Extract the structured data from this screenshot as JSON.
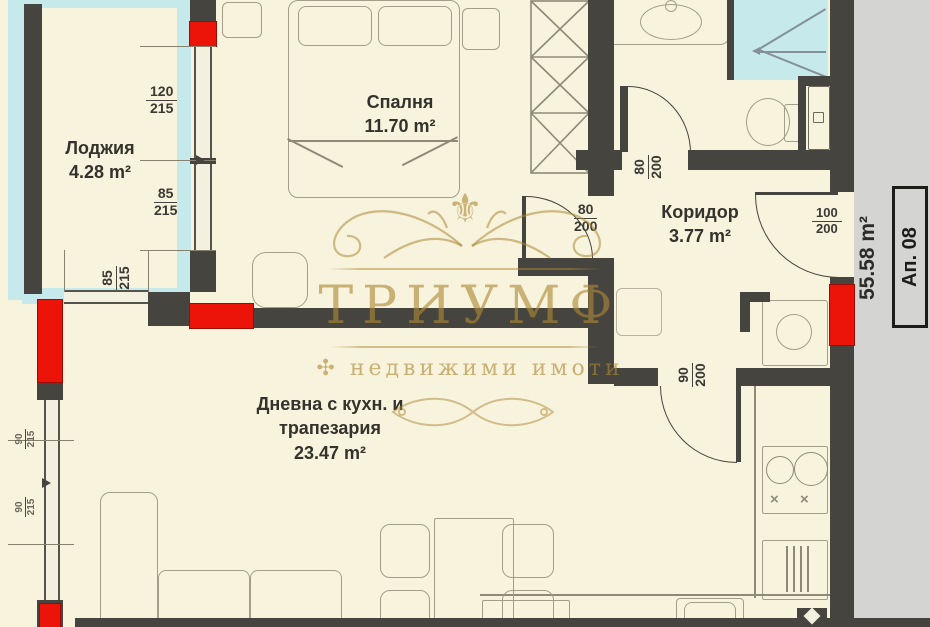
{
  "rooms": {
    "loggia": {
      "name": "Лоджия",
      "area": "4.28 m²"
    },
    "bedroom": {
      "name": "Спалня",
      "area": "11.70 m²"
    },
    "corridor": {
      "name": "Коридор",
      "area": "3.77 m²"
    },
    "living": {
      "name_line1": "Дневна с кухн. и",
      "name_line2": "трапезария",
      "area": "23.47 m²"
    }
  },
  "dims": {
    "loggia_win_top": {
      "num": "120",
      "den": "215"
    },
    "loggia_win_bottom": {
      "num": "85",
      "den": "215"
    },
    "loggia_south_win": {
      "num": "85",
      "den": "215"
    },
    "bedroom_door": {
      "num": "80",
      "den": "200"
    },
    "bathroom_door": {
      "num": "80",
      "den": "200"
    },
    "living_door": {
      "num": "90",
      "den": "200"
    },
    "entry_door": {
      "num": "100",
      "den": "200"
    },
    "west_window_a": {
      "num": "90",
      "den": "215"
    },
    "west_window_b": {
      "num": "90",
      "den": "215"
    }
  },
  "side": {
    "area": "55.58 m²",
    "apartment": "Ап. 08"
  },
  "watermark": {
    "brand": "ТРИУМФ",
    "mark": "✣",
    "tagline": "недвижими имоти",
    "fleur": "⚜"
  },
  "kitchen": {
    "burner_mark": "×"
  },
  "colors": {
    "wall": "#45443e",
    "accent_red": "#ec1309",
    "insulation": "#c6e9ec",
    "watermark_gold": "#b08d3e",
    "background": "#f7f3dd",
    "outside": "#d4d4d2"
  }
}
